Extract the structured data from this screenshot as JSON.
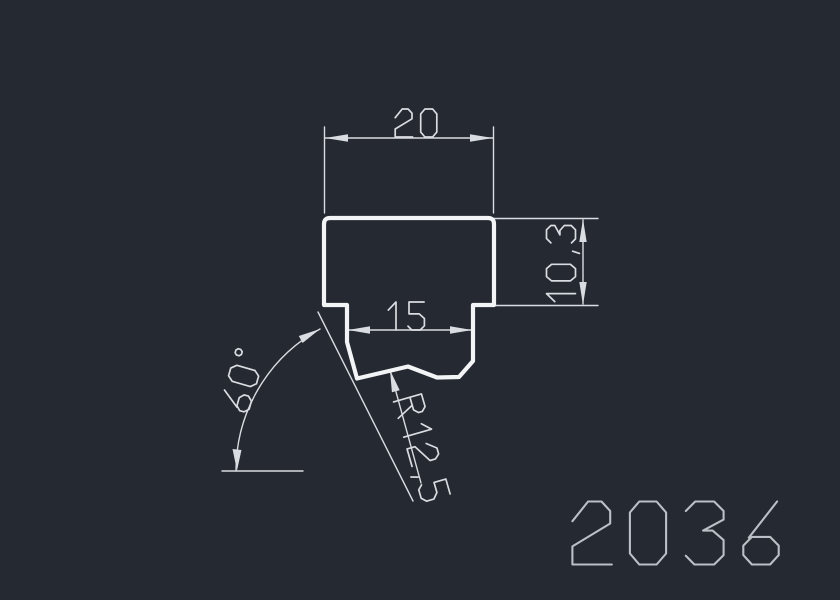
{
  "canvas": {
    "background": "#242932"
  },
  "colors": {
    "profile_line": "#f3f4f5",
    "dimension": "#d9dce0",
    "part_number": "#bac0c5"
  },
  "drawing": {
    "type": "extruded-profile-cross-section",
    "part_number": "2036",
    "dimensions": {
      "top_width": {
        "label": "20",
        "value": 20,
        "kind": "linear-horizontal"
      },
      "slot_width": {
        "label": "15",
        "value": 15,
        "kind": "linear-horizontal"
      },
      "right_height": {
        "label": "10,3",
        "value": 10.3,
        "kind": "linear-vertical"
      },
      "flank_angle": {
        "label": "60°",
        "value": 60,
        "kind": "angular"
      },
      "groove_radius": {
        "label": "R12,5",
        "value": 12.5,
        "kind": "radius-leader"
      }
    }
  }
}
